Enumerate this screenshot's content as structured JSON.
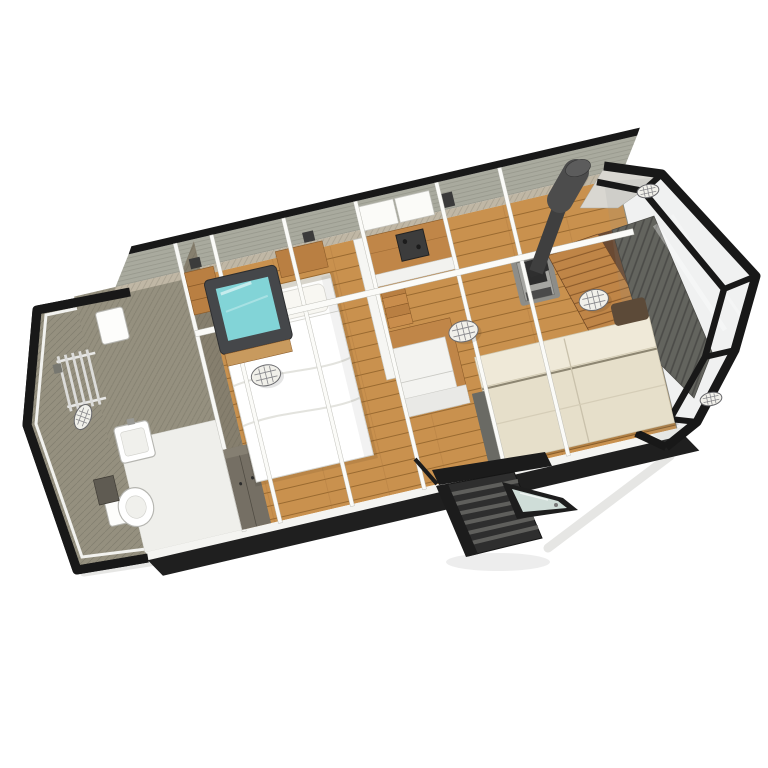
{
  "scene": {
    "type": "3d-floor-plan-render",
    "subject": "tiny-house-cabin-cutaway-top-view",
    "view": "aerial-isometric-cutaway",
    "rooms": [
      {
        "name": "bathroom",
        "features": [
          "towel-radiator",
          "boiler",
          "washbasin",
          "toilet",
          "mirror-cabinet",
          "shower-area",
          "wall-light"
        ]
      },
      {
        "name": "bedroom",
        "features": [
          "double-bed",
          "pillows",
          "roof-skylight",
          "wardrobe",
          "storage-cubbies",
          "ceiling-light"
        ]
      },
      {
        "name": "kitchen",
        "features": [
          "wall-counter",
          "cooktop",
          "upper-cabinets",
          "island-unit",
          "storage-steps",
          "tall-cabinet",
          "ceiling-light"
        ]
      },
      {
        "name": "living-room",
        "features": [
          "wood-stove",
          "chimney-flue",
          "sofa",
          "wood-slat-wall",
          "ribbed-panel-wall",
          "wall-lights"
        ]
      },
      {
        "name": "entrance",
        "features": [
          "exterior-steps",
          "open-glass-door",
          "glazed-gable-end"
        ]
      }
    ],
    "lights_count": 6
  },
  "colors": {
    "background": "#ffffff",
    "frame_black": "#181818",
    "floor_wood": "#c9914e",
    "counter_wood": "#c08648",
    "roof_band": "#a9aa9e",
    "wall_band": "#c0b7a5",
    "wall_gray": "#95907f",
    "partition_gray": "#867f6e",
    "bathroom_floor": "#efefeb",
    "bottom_rail": "#1f1f1f",
    "wall_white": "#f4f4f1",
    "beam_white": "#fbfbf8",
    "bed_white": "#fdfdfc",
    "duvet_white": "#ffffff",
    "pillow_white": "#f8f7f2",
    "skylight_frame": "#45474a",
    "skylight_glass": "#82d4d7",
    "skylight_sill": "#c89a5e",
    "wardrobe_dark": "#756f64",
    "cabinet_white": "#f3f3f0",
    "hob_dark": "#3c3c3c",
    "stove_gray": "#a6a6a2",
    "stove_top": "#2d2d2d",
    "chimney": "#3f3f3f",
    "chimney_cap": "#4c4c4c",
    "sofa_back": "#efe9d8",
    "sofa_seat": "#e6dfca",
    "sofa_arm": "#6a6a64",
    "sofa_bolster": "#5c4a38",
    "slat_wood": "#bf8547",
    "walnut": "#6a4a33",
    "panel_dark": "#5e5d57",
    "door_frame": "#1d1d1d",
    "door_glass": "#d9e8e3",
    "steps_dark": "#2e2e2e",
    "step_tread": "#5f5f5c",
    "lamp_white": "#f1f0ea",
    "shadow": "#e0e0dd"
  }
}
